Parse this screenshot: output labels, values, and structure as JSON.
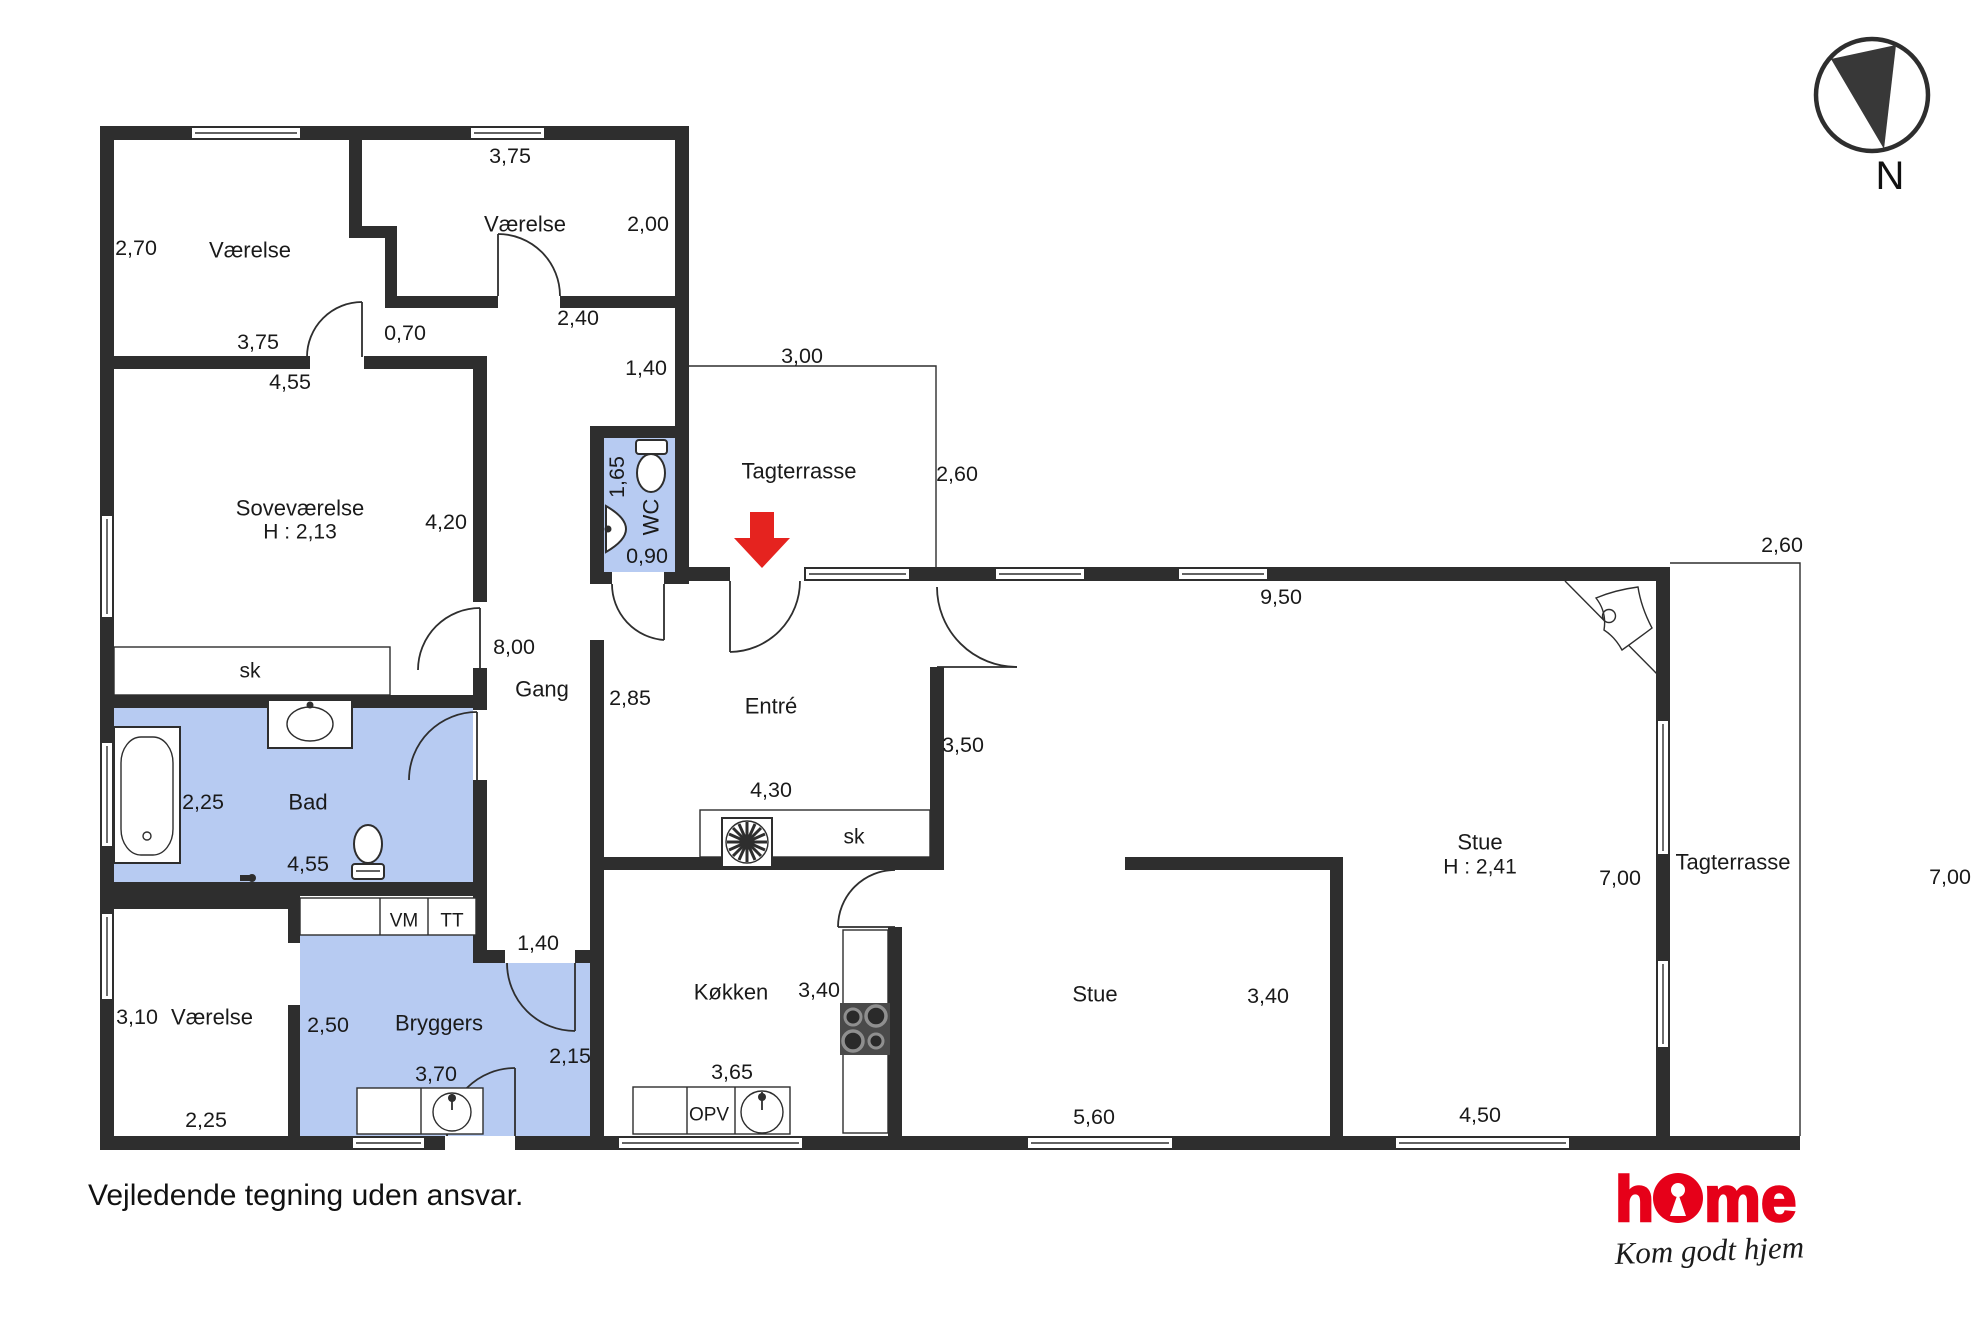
{
  "palette": {
    "wall_color": "#2e2e2e",
    "wet_room_fill": "#b7cbf2",
    "entrance_arrow_red": "#e5231f",
    "logo_red": "#e60019"
  },
  "footer": {
    "disclaimer": "Vejledende tegning uden ansvar."
  },
  "brand": {
    "name_h": "h",
    "name_me": "me",
    "tagline": "Kom godt hjem"
  },
  "compass": {
    "label": "N"
  },
  "floorplan": {
    "labels": [
      {
        "t": "2,70",
        "x": 136,
        "y": 248,
        "k": "dim",
        "n": "dim-vaerelse1-height"
      },
      {
        "t": "Værelse",
        "x": 250,
        "y": 250,
        "k": "room",
        "n": "room-vaerelse-1"
      },
      {
        "t": "3,75",
        "x": 258,
        "y": 342,
        "k": "dim",
        "n": "dim-vaerelse1-width"
      },
      {
        "t": "0,70",
        "x": 405,
        "y": 333,
        "k": "dim",
        "n": "dim-passage"
      },
      {
        "t": "3,75",
        "x": 510,
        "y": 156,
        "k": "dim",
        "n": "dim-vaerelse2-width"
      },
      {
        "t": "Værelse",
        "x": 525,
        "y": 224,
        "k": "room",
        "n": "room-vaerelse-2"
      },
      {
        "t": "2,00",
        "x": 648,
        "y": 224,
        "k": "dim",
        "n": "dim-vaerelse2-height"
      },
      {
        "t": "2,40",
        "x": 578,
        "y": 318,
        "k": "dim",
        "n": "dim-corridor-top"
      },
      {
        "t": "1,40",
        "x": 646,
        "y": 368,
        "k": "dim",
        "n": "dim-corridor-right"
      },
      {
        "t": "4,55",
        "x": 290,
        "y": 382,
        "k": "dim",
        "n": "dim-sovevaerelse-width"
      },
      {
        "t": "Soveværelse",
        "x": 300,
        "y": 508,
        "k": "room",
        "n": "room-sovevaerelse"
      },
      {
        "t": "H : 2,13",
        "x": 300,
        "y": 532,
        "k": "sub",
        "n": "ceiling-sovevaerelse"
      },
      {
        "t": "4,20",
        "x": 446,
        "y": 522,
        "k": "dim",
        "n": "dim-sovevaerelse-height"
      },
      {
        "t": "3,00",
        "x": 802,
        "y": 356,
        "k": "dim",
        "n": "dim-tagterrasse-top-width"
      },
      {
        "t": "Tagterrasse",
        "x": 799,
        "y": 471,
        "k": "room",
        "n": "room-tagterrasse-top"
      },
      {
        "t": "2,60",
        "x": 957,
        "y": 474,
        "k": "dim",
        "n": "dim-tagterrasse-top-depth"
      },
      {
        "t": "1,65",
        "x": 617,
        "y": 477,
        "k": "dim",
        "n": "dim-wc-depth",
        "r": -90
      },
      {
        "t": "WC",
        "x": 651,
        "y": 517,
        "k": "room",
        "n": "room-wc",
        "r": -90
      },
      {
        "t": "0,90",
        "x": 647,
        "y": 556,
        "k": "dim",
        "n": "dim-wc-width"
      },
      {
        "t": "8,00",
        "x": 514,
        "y": 647,
        "k": "dim",
        "n": "dim-gang-length"
      },
      {
        "t": "Gang",
        "x": 542,
        "y": 689,
        "k": "room",
        "n": "room-gang"
      },
      {
        "t": "2,85",
        "x": 630,
        "y": 698,
        "k": "dim",
        "n": "dim-entre-west"
      },
      {
        "t": "Entré",
        "x": 771,
        "y": 706,
        "k": "room",
        "n": "room-entre"
      },
      {
        "t": "3,50",
        "x": 963,
        "y": 745,
        "k": "dim",
        "n": "dim-entre-east"
      },
      {
        "t": "4,30",
        "x": 771,
        "y": 790,
        "k": "dim",
        "n": "dim-entre-width"
      },
      {
        "t": "sk",
        "x": 250,
        "y": 671,
        "k": "sub",
        "n": "closet-sovevaerelse"
      },
      {
        "t": "sk",
        "x": 854,
        "y": 837,
        "k": "sub",
        "n": "closet-entre"
      },
      {
        "t": "9,50",
        "x": 1281,
        "y": 597,
        "k": "dim",
        "n": "dim-stue-top"
      },
      {
        "t": "Stue",
        "x": 1480,
        "y": 842,
        "k": "room",
        "n": "room-stue-main"
      },
      {
        "t": "H : 2,41",
        "x": 1480,
        "y": 867,
        "k": "sub",
        "n": "ceiling-stue"
      },
      {
        "t": "7,00",
        "x": 1620,
        "y": 878,
        "k": "dim",
        "n": "dim-stue-east"
      },
      {
        "t": "Tagterrasse",
        "x": 1733,
        "y": 862,
        "k": "room",
        "n": "room-tagterrasse-right"
      },
      {
        "t": "7,00",
        "x": 1950,
        "y": 877,
        "k": "dim",
        "n": "dim-tagterrasse-right-depth"
      },
      {
        "t": "2,60",
        "x": 1782,
        "y": 545,
        "k": "dim",
        "n": "dim-tagterrasse-right-width"
      },
      {
        "t": "2,25",
        "x": 203,
        "y": 802,
        "k": "dim",
        "n": "dim-bad-height"
      },
      {
        "t": "Bad",
        "x": 308,
        "y": 802,
        "k": "room",
        "n": "room-bad"
      },
      {
        "t": "4,55",
        "x": 308,
        "y": 864,
        "k": "dim",
        "n": "dim-bad-width"
      },
      {
        "t": "VM",
        "x": 404,
        "y": 921,
        "k": "fix",
        "n": "appliance-vm"
      },
      {
        "t": "TT",
        "x": 452,
        "y": 921,
        "k": "fix",
        "n": "appliance-tt"
      },
      {
        "t": "3,10",
        "x": 137,
        "y": 1017,
        "k": "dim",
        "n": "dim-vaerelse3-height"
      },
      {
        "t": "Værelse",
        "x": 212,
        "y": 1017,
        "k": "room",
        "n": "room-vaerelse-3"
      },
      {
        "t": "2,25",
        "x": 206,
        "y": 1120,
        "k": "dim",
        "n": "dim-vaerelse3-width"
      },
      {
        "t": "2,50",
        "x": 328,
        "y": 1025,
        "k": "dim",
        "n": "dim-bryggers-left"
      },
      {
        "t": "Bryggers",
        "x": 439,
        "y": 1023,
        "k": "room",
        "n": "room-bryggers"
      },
      {
        "t": "3,70",
        "x": 436,
        "y": 1074,
        "k": "dim",
        "n": "dim-bryggers-width"
      },
      {
        "t": "1,40",
        "x": 538,
        "y": 943,
        "k": "dim",
        "n": "dim-gang-end"
      },
      {
        "t": "2,15",
        "x": 570,
        "y": 1056,
        "k": "dim",
        "n": "dim-bryggers-right"
      },
      {
        "t": "Køkken",
        "x": 731,
        "y": 992,
        "k": "room",
        "n": "room-koekken"
      },
      {
        "t": "3,40",
        "x": 819,
        "y": 990,
        "k": "dim",
        "n": "dim-koekken-height"
      },
      {
        "t": "3,65",
        "x": 732,
        "y": 1072,
        "k": "dim",
        "n": "dim-koekken-width"
      },
      {
        "t": "OPV",
        "x": 709,
        "y": 1115,
        "k": "fix",
        "n": "appliance-opv"
      },
      {
        "t": "Stue",
        "x": 1095,
        "y": 994,
        "k": "room",
        "n": "room-stue-lower"
      },
      {
        "t": "3,40",
        "x": 1268,
        "y": 996,
        "k": "dim",
        "n": "dim-stue-lower-depth"
      },
      {
        "t": "5,60",
        "x": 1094,
        "y": 1117,
        "k": "dim",
        "n": "dim-stue-lower-width"
      },
      {
        "t": "4,50",
        "x": 1480,
        "y": 1115,
        "k": "dim",
        "n": "dim-stue-main-width"
      }
    ]
  }
}
